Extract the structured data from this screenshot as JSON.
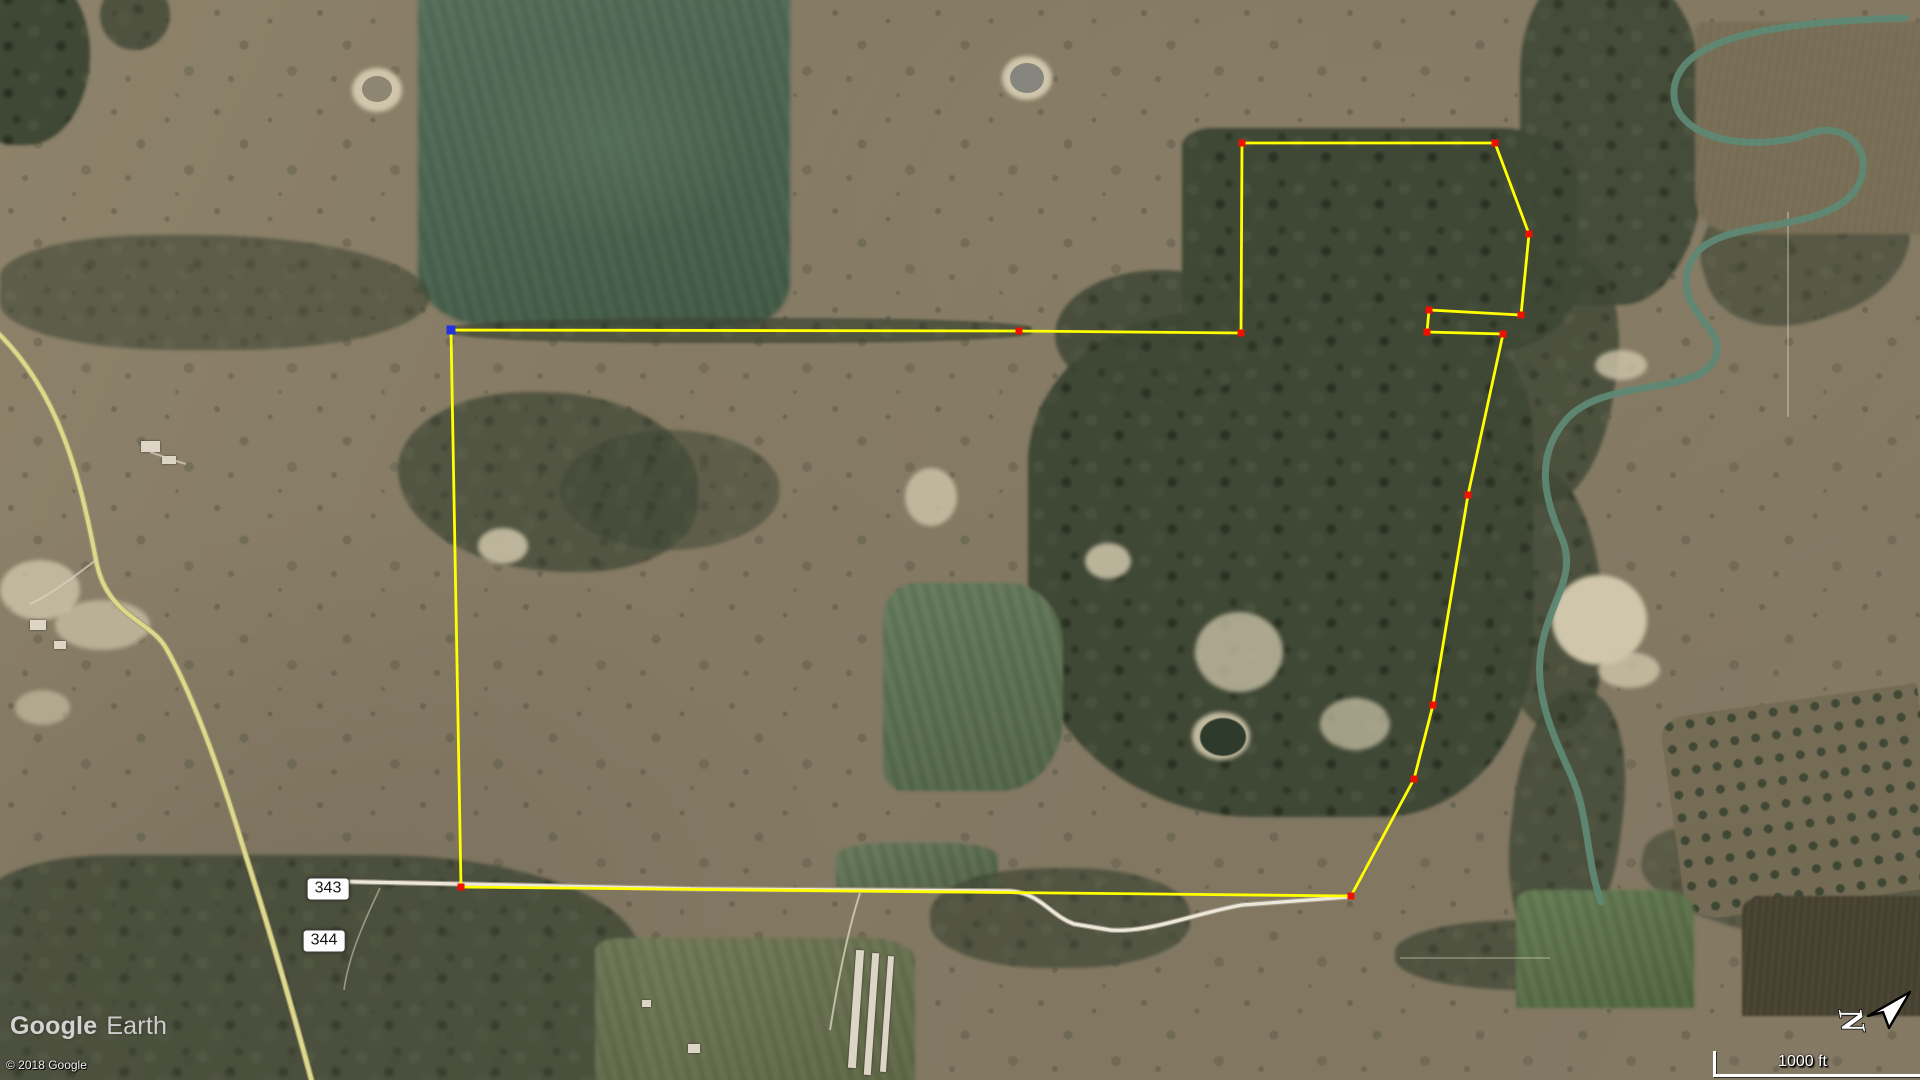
{
  "app": "Google Earth satellite view with measured property boundary",
  "attribution": {
    "logo_primary": "Google",
    "logo_secondary": "Earth",
    "copyright": "© 2018 Google"
  },
  "scale_bar": {
    "label": "1000 ft"
  },
  "compass": {
    "letter": "N"
  },
  "map_overlay": {
    "road_labels": [
      {
        "label": "343",
        "x": 328,
        "y": 889
      },
      {
        "label": "344",
        "x": 324,
        "y": 941
      }
    ],
    "boundary": {
      "line_color": "#ffff00",
      "vertex_color": "#ee1100",
      "start_vertex_color": "#2230e0",
      "line_width": 2.8,
      "closed": true,
      "vertices": [
        {
          "x": 451,
          "y": 330,
          "marker": "start"
        },
        {
          "x": 1019,
          "y": 331,
          "marker": "point"
        },
        {
          "x": 1241,
          "y": 333,
          "marker": "point"
        },
        {
          "x": 1242,
          "y": 143,
          "marker": "point"
        },
        {
          "x": 1495,
          "y": 143,
          "marker": "point"
        },
        {
          "x": 1529,
          "y": 234,
          "marker": "point"
        },
        {
          "x": 1521,
          "y": 315,
          "marker": "point"
        },
        {
          "x": 1429,
          "y": 310,
          "marker": "point"
        },
        {
          "x": 1427,
          "y": 332,
          "marker": "point"
        },
        {
          "x": 1503,
          "y": 334,
          "marker": "point"
        },
        {
          "x": 1468,
          "y": 495,
          "marker": "point"
        },
        {
          "x": 1433,
          "y": 705,
          "marker": "point"
        },
        {
          "x": 1414,
          "y": 779,
          "marker": "point"
        },
        {
          "x": 1351,
          "y": 896,
          "marker": "point"
        },
        {
          "x": 461,
          "y": 887,
          "marker": "point"
        }
      ]
    },
    "colors": {
      "route_road": "#ded98a",
      "dirt_road": "#ece7db",
      "river_water": "#5e8874"
    }
  }
}
